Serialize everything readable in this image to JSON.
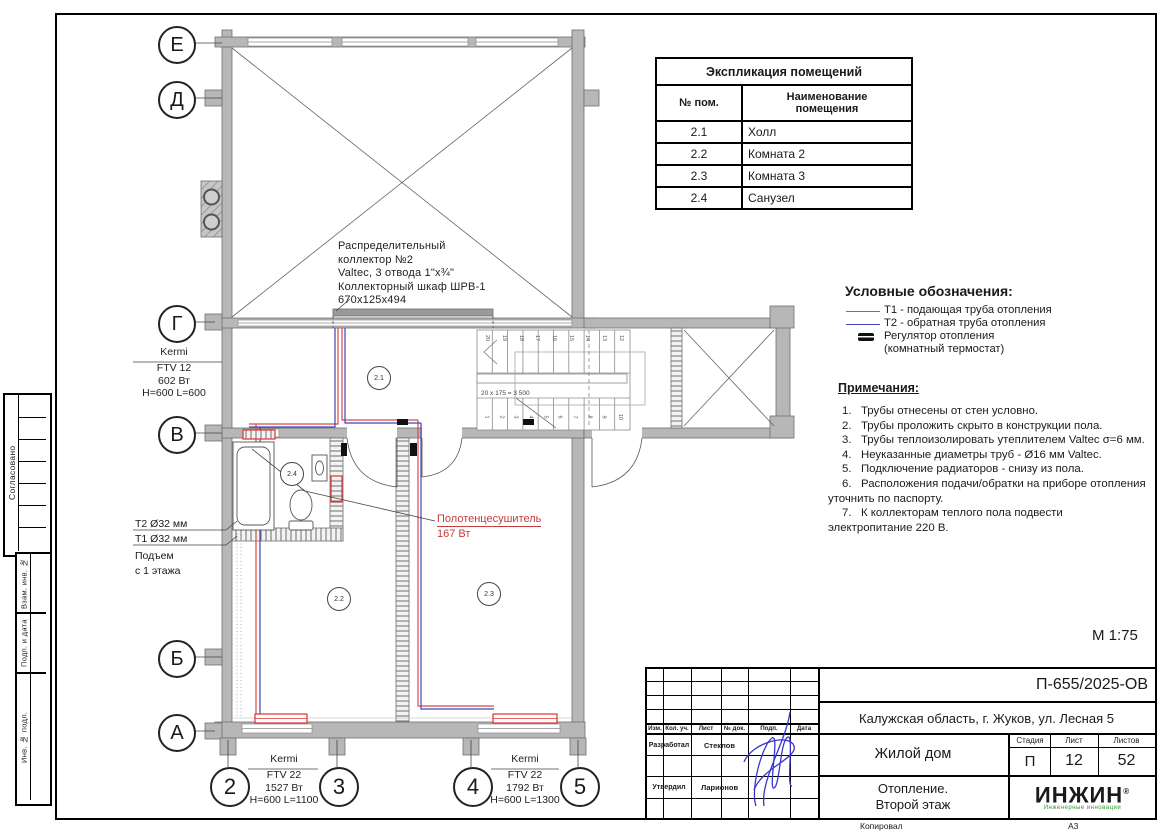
{
  "colors": {
    "t1_red": "#d84a4a",
    "t2_blue": "#4444b8",
    "radiator_red": "#e03030",
    "logo_green": "#2e9e2e",
    "signature_blue": "#3a35cc",
    "wall_gray": "#b7b7b7"
  },
  "plan": {
    "axes_rows": [
      "Е",
      "Д",
      "Г",
      "В",
      "Б",
      "А"
    ],
    "axes_cols": [
      "2",
      "3",
      "4",
      "5"
    ],
    "room_tags": [
      "2.1",
      "2.2",
      "2.3",
      "2.4"
    ],
    "stair_upper_numbers": [
      "20",
      "19",
      "18",
      "17",
      "16",
      "15",
      "14",
      "13",
      "12"
    ],
    "stair_lower_numbers": [
      "1",
      "2",
      "3",
      "4",
      "5",
      "6",
      "7",
      "8",
      "9",
      "10"
    ],
    "stair_formula": "20 х 175 = 3 500",
    "scale": "М 1:75"
  },
  "annotations": {
    "collector_lines": [
      "Распределительный",
      "коллектор №2",
      "Valtec, 3 отвода 1\"х¾\"",
      "Коллекторный шкаф ШРВ-1",
      "670х125х494"
    ],
    "radiator_left": {
      "brand": "Kermi",
      "model": "FTV 12",
      "power": "602 Вт",
      "size": "H=600 L=600"
    },
    "radiator_room2": {
      "brand": "Kermi",
      "model": "FTV 22",
      "power": "1527 Вт",
      "size": "H=600 L=1100"
    },
    "radiator_room3": {
      "brand": "Kermi",
      "model": "FTV 22",
      "power": "1792 Вт",
      "size": "H=600 L=1300"
    },
    "t2_label": "Т2 Ø32 мм",
    "t1_label": "Т1 Ø32 мм",
    "riser_line1": "Подъем",
    "riser_line2": "с 1 этажа",
    "towel_name": "Полотенцесушитель",
    "towel_power": "167 Вт"
  },
  "explication": {
    "title": "Экспликация помещений",
    "col_num": "№ пом.",
    "col_name": "Наименование помещения",
    "rows": [
      {
        "num": "2.1",
        "name": "Холл"
      },
      {
        "num": "2.2",
        "name": "Комната 2"
      },
      {
        "num": "2.3",
        "name": "Комната 3"
      },
      {
        "num": "2.4",
        "name": "Санузел"
      }
    ]
  },
  "legend": {
    "title": "Условные обозначения:",
    "t1_label": "Т1 - подающая труба отопления",
    "t2_label": "Т2 - обратная труба отопления",
    "thermostat_label1": "Регулятор отопления",
    "thermostat_label2": "(комнатный термостат)"
  },
  "notes": {
    "title": "Примечания:",
    "items": [
      "1.   Трубы отнесены от стен условно.",
      "2.   Трубы проложить скрыто в конструкции пола.",
      "3.   Трубы теплоизолировать утеплителем Valtec σ=6 мм.",
      "4.   Неуказанные диаметры труб - Ø16 мм Valtec.",
      "5.   Подключение радиаторов - снизу из пола.",
      "6.   Расположения подачи/обратки на приборе отопления уточнить по паспорту.",
      "7.   К коллекторам теплого пола подвести электропитание 220 В."
    ]
  },
  "titleblock": {
    "doc_number": "П-655/2025-ОВ",
    "address": "Калужская область, г. Жуков, ул. Лесная 5",
    "object": "Жилой дом",
    "title_line1": "Отопление.",
    "title_line2": "Второй этаж",
    "stage_label": "Стадия",
    "sheet_label": "Лист",
    "sheets_label": "Листов",
    "stage": "П",
    "sheet": "12",
    "sheets": "52",
    "header_cols": [
      "Изм.",
      "Кол. уч.",
      "Лист",
      "№ док.",
      "Подп.",
      "Дата"
    ],
    "row_developed_label": "Разработал",
    "row_developed_name": "Стеклов",
    "row_approved_label": "Утвердил",
    "row_approved_name": "Ларионов",
    "logo": "ИНЖИН",
    "logo_reg": "®",
    "logo_sub": "Инженерные инновации"
  },
  "side_stamp": {
    "soglasovano": "Согласовано",
    "vzam": "Взам. инв. №",
    "podp": "Подп. и дата",
    "inv": "Инв. № подл."
  },
  "footer": {
    "kopiroval": "Копировал",
    "format": "А3"
  }
}
